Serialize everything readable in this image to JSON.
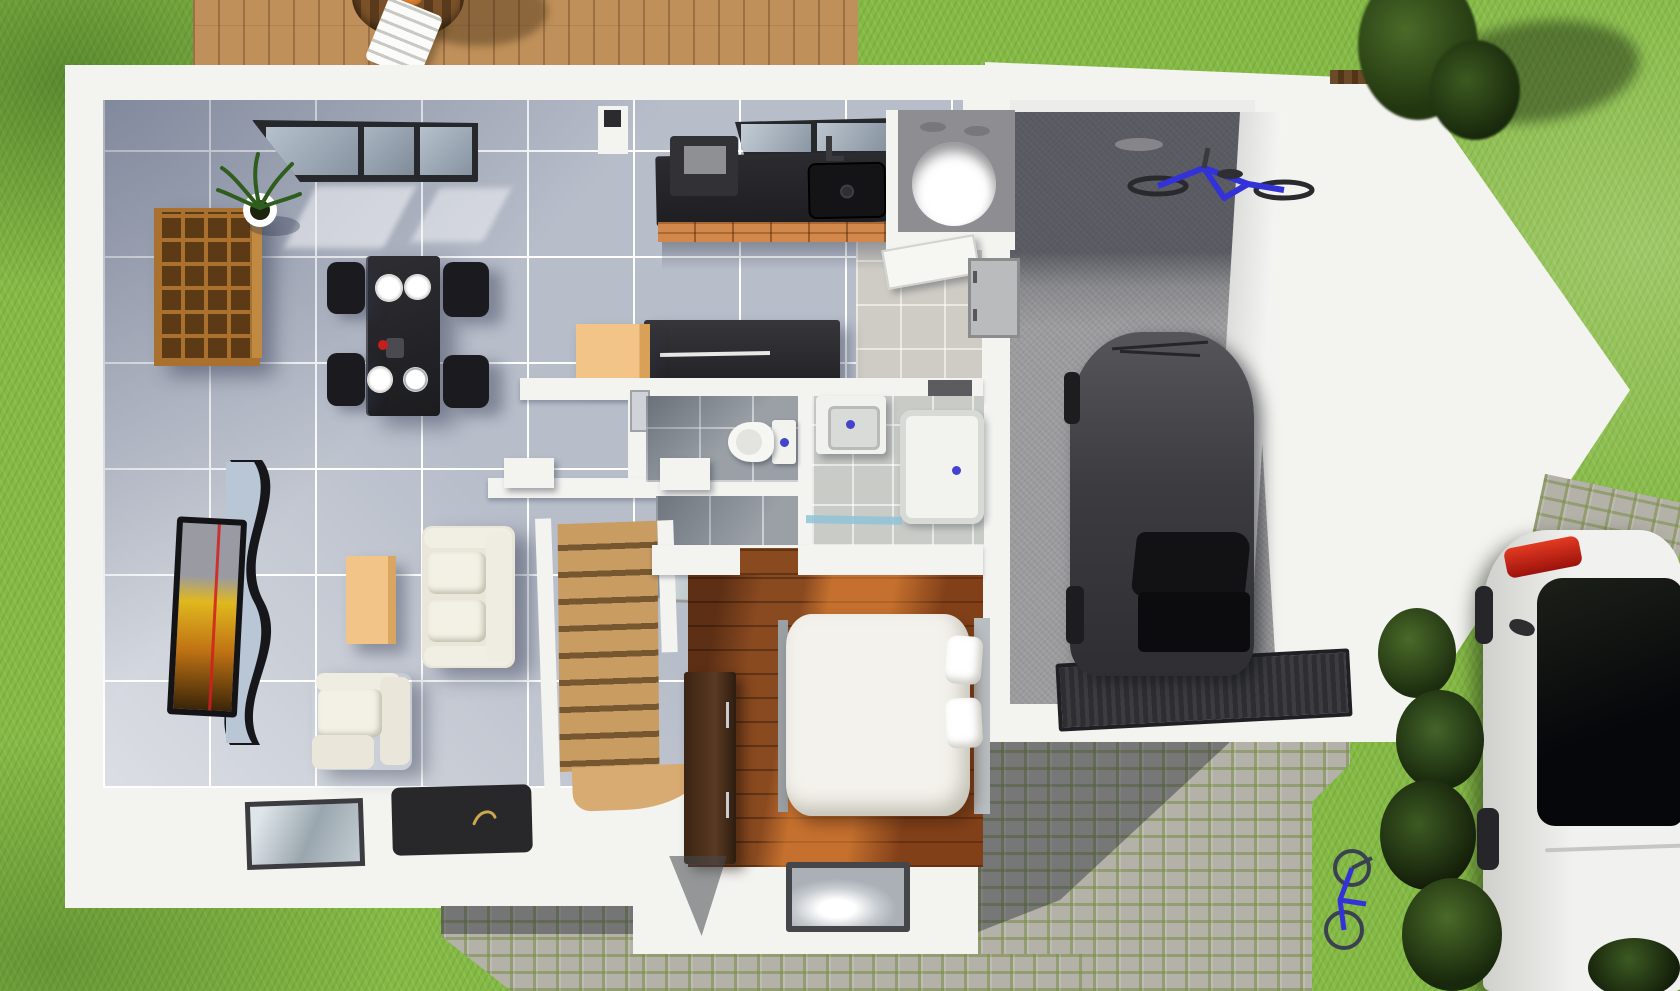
{
  "scene": {
    "title": "Top-down 3D floor-plan rendering of a single-storey house with attached garage, lawn, wooden deck and cobblestone driveway",
    "view": "top-down 3D render",
    "colors": {
      "grass": "#85ba45",
      "deck-wood": "#c0905a",
      "wall": "#f3f3f0",
      "tile": "#b7bdc9",
      "tile-grout": "#ffffff",
      "gray-tile": "#9aa0a6",
      "warm-tile": "#cfccc5",
      "wood-floor": "#8a4a20",
      "stair-wood": "#c99c62",
      "counter-black": "#232327",
      "cabinet-orange": "#d2884a",
      "island-gray": "#323236",
      "beige": "#f2c488",
      "cream": "#eae7da",
      "furniture-black": "#1b1b1f",
      "concrete": "#9b9b9d",
      "cobble": "#b4b1a8",
      "car-gray": "#48484c",
      "car-white": "#ebebe9",
      "taillight-red": "#d2201a",
      "bike-blue": "#3232d8",
      "drain-blue": "#4343cc",
      "glass": "#97a2ae",
      "frame-dark": "#26282c"
    },
    "outdoor": {
      "lawn": {
        "label": "Lawn"
      },
      "deck": {
        "label": "Wooden deck with round table and white chair"
      },
      "driveway": {
        "label": "Cobblestone driveway"
      },
      "garden_path": {
        "label": "Cobblestone garden path"
      },
      "trees": {
        "label": "Trees and hedge"
      },
      "parked_car": {
        "label": "White car parked beside the garage"
      },
      "kids_bike": {
        "label": "Small blue bicycle on the lawn"
      }
    },
    "house": {
      "living_room": {
        "label": "Living room — wavy TV sideboard, flat TV, cream sofa, armchair, beige coffee table, dark rug, cube shelf, potted plant, sliding glass door"
      },
      "dining_area": {
        "label": "Dining area — black table, four chairs, four white plates, vase with red flower"
      },
      "kitchen": {
        "label": "Kitchen — black counter with sink, orange base cabinets, window over sink, coffee machine, island, beige cabinet"
      },
      "wc": {
        "label": "Guest WC — wall-hung toilet"
      },
      "bathroom": {
        "label": "Bathroom — vanity basin and walk-in shower"
      },
      "utility_room": {
        "label": "Utility room — water heater cylinder"
      },
      "hallway": {
        "label": "Entry hall with door to garage"
      },
      "stairs": {
        "label": "Wooden staircase"
      },
      "bedroom": {
        "label": "Bedroom — double bed, wardrobe, window"
      }
    },
    "garage": {
      "label": "Garage — dark gray car, blue bicycle, ribbed floor mat"
    }
  }
}
